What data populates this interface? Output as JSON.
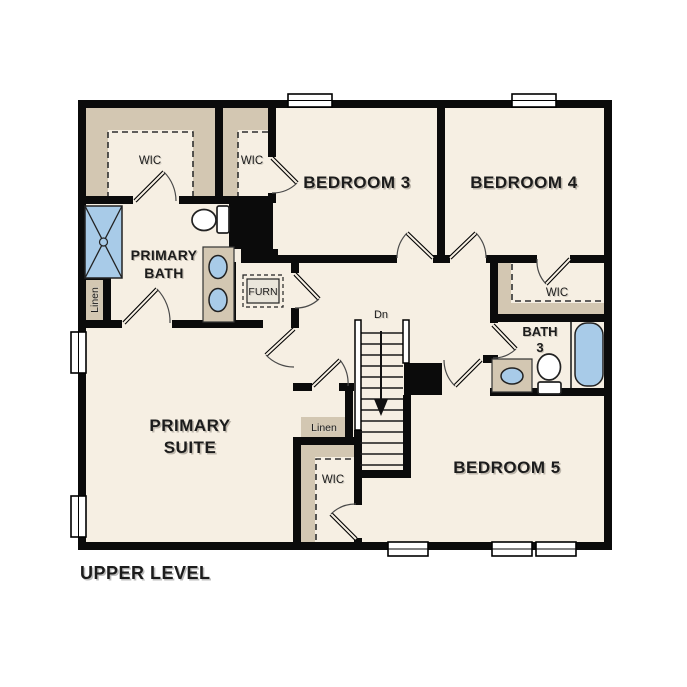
{
  "title": "UPPER LEVEL",
  "colors": {
    "background": "#ffffff",
    "floor": "#f6efe3",
    "wall": "#0b0b0b",
    "shelving": "#d3c7b2",
    "fixture_blue": "#a8cbe8",
    "label_text": "#1c1c1c"
  },
  "labels": {
    "wic_primary": "WIC",
    "wic_bed3": "WIC",
    "bedroom3": "BEDROOM 3",
    "bedroom4": "BEDROOM 4",
    "primary_bath_line1": "PRIMARY",
    "primary_bath_line2": "BATH",
    "linen_primary": "Linen",
    "furnace": "FURN",
    "wic_bed4": "WIC",
    "bath3_line1": "BATH",
    "bath3_line2": "3",
    "stairs_direction": "Dn",
    "primary_suite_line1": "PRIMARY",
    "primary_suite_line2": "SUITE",
    "linen_hall": "Linen",
    "wic_bed5": "WIC",
    "bedroom5": "BEDROOM 5",
    "plan_title": "UPPER LEVEL"
  },
  "fixtures": [
    "shower",
    "toilet-primary",
    "double-sink-vanity",
    "furnace-unit",
    "sink-vanity-bath3",
    "toilet-bath3",
    "bathtub",
    "staircase-down"
  ],
  "rooms": [
    "WIC",
    "WIC",
    "BEDROOM 3",
    "BEDROOM 4",
    "PRIMARY BATH",
    "Linen",
    "PRIMARY SUITE",
    "FURN",
    "WIC",
    "BATH 3",
    "Linen",
    "WIC",
    "BEDROOM 5"
  ]
}
